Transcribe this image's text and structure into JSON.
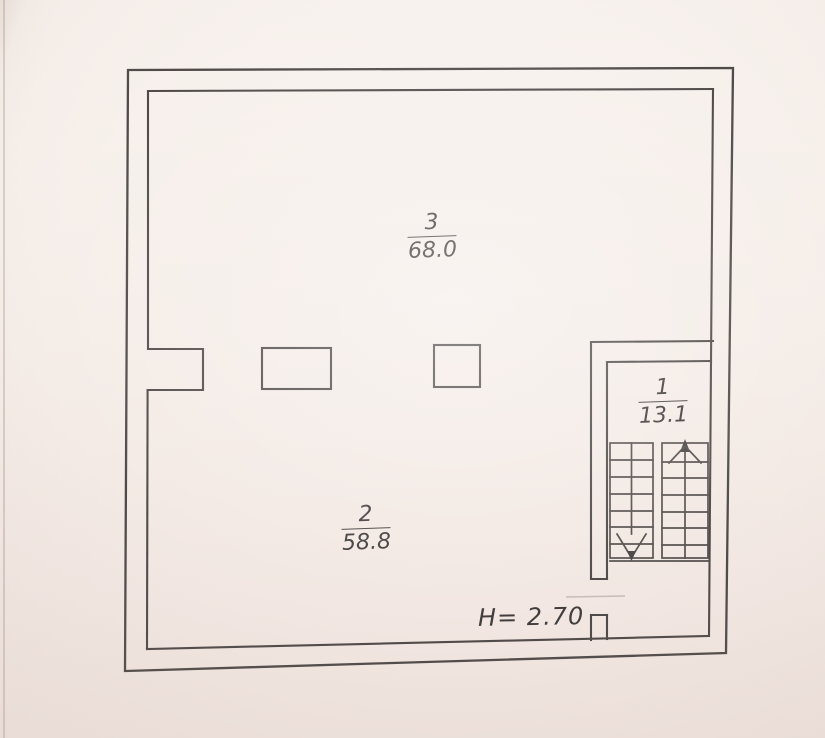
{
  "drawing": {
    "type": "floor-plan",
    "rooms": [
      {
        "number": "3",
        "area": "68.0"
      },
      {
        "number": "2",
        "area": "58.8"
      },
      {
        "number": "1",
        "area": "13.1"
      }
    ],
    "height_note": "H= 2.70",
    "stairwell": {
      "flights": 2,
      "left_flight_arrow": "stair-down-arrow",
      "right_flight_arrow": "stair-up-arrow"
    }
  },
  "colors": {
    "paper": "#f5ede8",
    "wall_line": "#4f4a48",
    "ink": "#413d3c",
    "faint_line": "#c6bdb6"
  }
}
